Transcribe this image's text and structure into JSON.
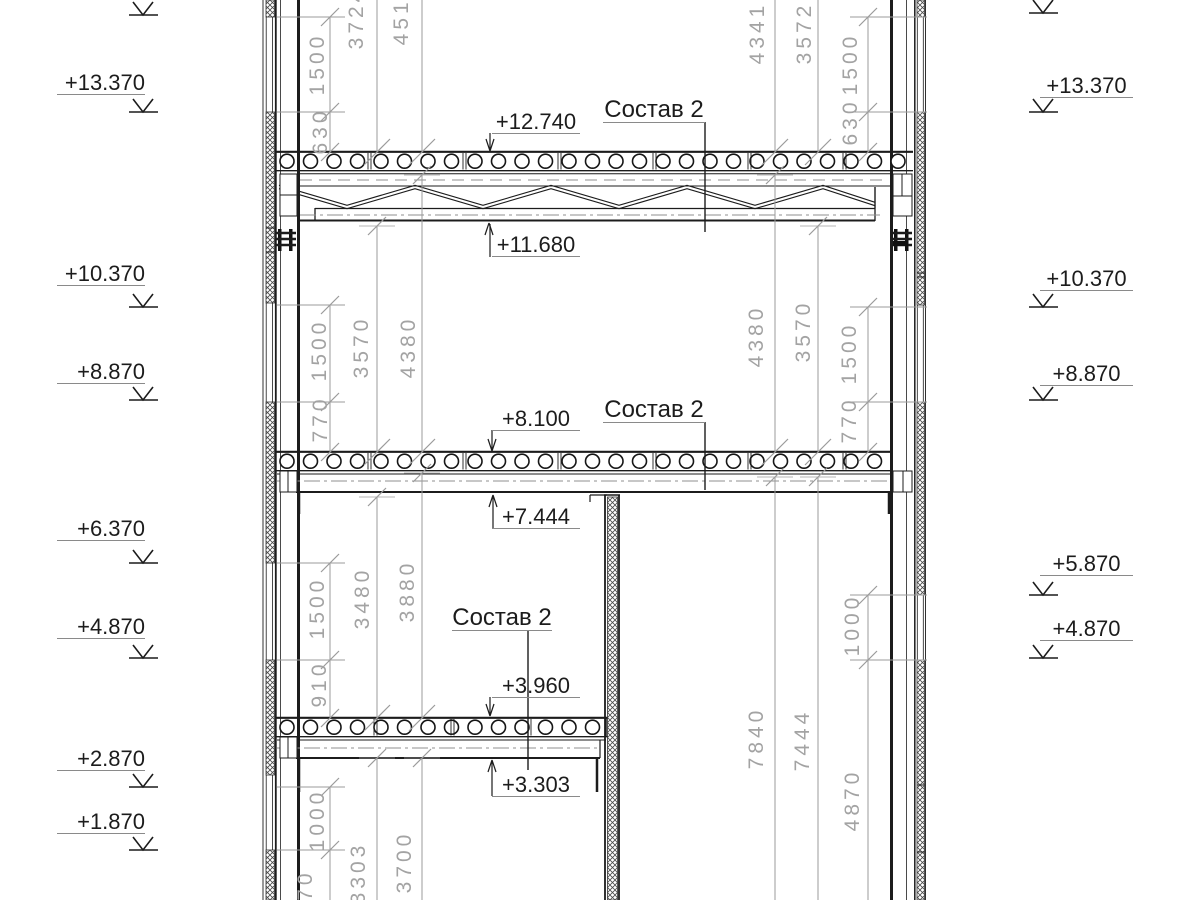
{
  "composition_labels": [
    "Состав 2",
    "Состав 2",
    "Состав 2"
  ],
  "level_callouts": [
    "+12.740",
    "+11.680",
    "+8.100",
    "+7.444",
    "+3.960",
    "+3.303"
  ],
  "elevations_left": [
    "+13.370",
    "+10.370",
    "+8.870",
    "+6.370",
    "+4.870",
    "+2.870",
    "+1.870"
  ],
  "elevations_right": [
    "+13.370",
    "+10.370",
    "+8.870",
    "+5.870",
    "+4.870"
  ],
  "dimensions_left": [
    "1500",
    "630",
    "3724",
    "4516",
    "1500",
    "770",
    "3570",
    "4380",
    "1500",
    "910",
    "3480",
    "3880",
    "1000",
    "970",
    "3303",
    "3700"
  ],
  "dimensions_right": [
    "4341",
    "3572",
    "1500",
    "630",
    "4380",
    "3570",
    "1500",
    "770",
    "1000",
    "7840",
    "7444",
    "4870"
  ],
  "colors": {
    "line": "#1c1c1c",
    "dim": "#9b9b9b",
    "centerline": "#8f8f8f"
  }
}
